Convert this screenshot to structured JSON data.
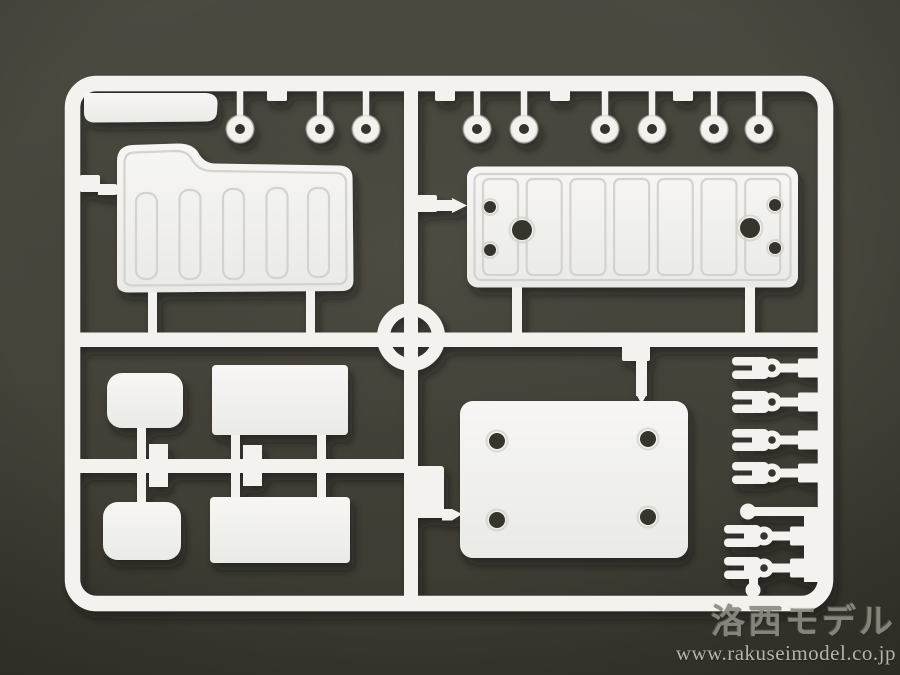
{
  "scene": {
    "type": "photograph",
    "subject": "White injection-molded plastic model kit sprue (parts runner) photographed on a dark olive-gray background",
    "orientation": "landscape"
  },
  "watermark": {
    "line1": "洛西モデル",
    "line2": "www.rakuseimodel.co.jp"
  },
  "colors": {
    "plastic": "#f3f2ef",
    "plastic-bright": "#fbfbfa",
    "plastic-shade": "#e7e6e2",
    "line": "#d4d3ce",
    "hole": "#36352e",
    "bg-top": "#4b4940",
    "bg-bottom": "#3a382f",
    "wm1": "#8d8b82",
    "wm2": "#b6b3a9"
  },
  "sprue": {
    "frame": {
      "shape": "rounded rectangle runner frame",
      "runner_width_px": 15
    },
    "center_ring": {
      "cx": 411,
      "cy": 337,
      "outer_r": 34
    },
    "washers": {
      "count": 9,
      "y": 129,
      "xs": [
        240,
        320,
        366,
        477,
        524,
        605,
        652,
        714,
        759
      ]
    },
    "rail_stubs": [
      277,
      445,
      560,
      683
    ],
    "forks": {
      "count": 6,
      "upper_eye_x": 772,
      "upper_ys": [
        368,
        402,
        440,
        473
      ],
      "lower_eye_x": 764,
      "lower_ys": [
        536,
        568
      ]
    },
    "parts_inventory": [
      {
        "name": "flat-bar",
        "qty": 1,
        "note": "long flat bar under top rail, upper left"
      },
      {
        "name": "ribbed-side-panel",
        "qty": 1,
        "note": "large panel with raised hump and 5 vertical rib slots, upper left"
      },
      {
        "name": "ribbed-plate-with-holes",
        "qty": 1,
        "note": "long plate with rib slots, two small holes and one large hole each end, upper right"
      },
      {
        "name": "round-bushing",
        "qty": 9,
        "note": "small donut washers hanging from top rail"
      },
      {
        "name": "small-rounded-plate",
        "qty": 2,
        "note": "rounded rectangles, lower left"
      },
      {
        "name": "rectangular-plate",
        "qty": 2,
        "note": "plain rectangles, lower left"
      },
      {
        "name": "mount-plate-4-holes",
        "qty": 1,
        "note": "large plate with four holes, lower center"
      },
      {
        "name": "clevis-fork",
        "qty": 6,
        "note": "forked rod-end pieces on right rail"
      }
    ]
  }
}
